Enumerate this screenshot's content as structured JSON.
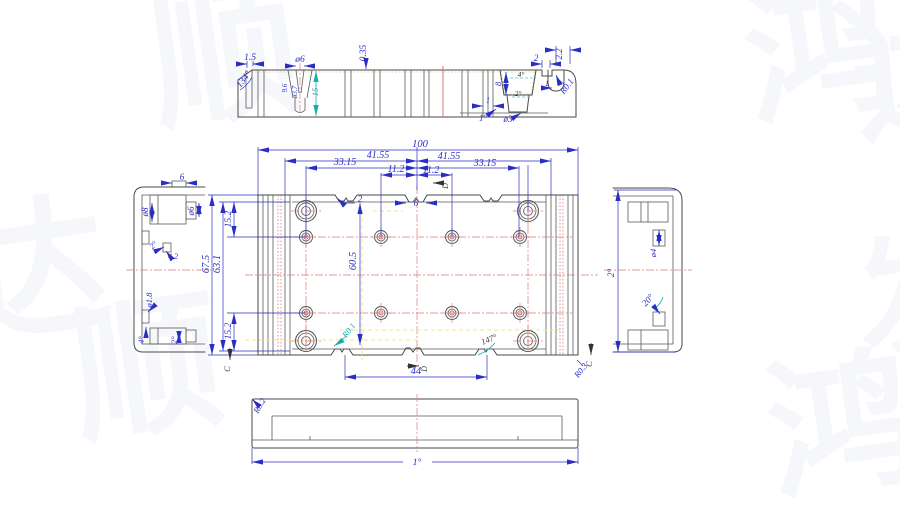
{
  "drawing_title": "sheet-metal-enclosure-base-cad-drawing",
  "colors": {
    "dimension_blue": "#2a2ec4",
    "outline_gray": "#4a4a4a",
    "centerline_red": "#e07a7a",
    "highlight_yellow": "#ece98a",
    "aux_teal": "#12aeb4",
    "watermark": "#f6f7fb"
  },
  "watermarks": [
    {
      "text": "顺",
      "x": 150,
      "y": -18,
      "size": 150,
      "rotate": -8
    },
    {
      "text": "鸿",
      "x": 745,
      "y": -22,
      "size": 150,
      "rotate": -8
    },
    {
      "text": "达",
      "x": 852,
      "y": 8,
      "size": 140,
      "rotate": -8
    },
    {
      "text": "达",
      "x": -42,
      "y": 198,
      "size": 150,
      "rotate": -8
    },
    {
      "text": "顺",
      "x": 72,
      "y": 295,
      "size": 150,
      "rotate": -8
    },
    {
      "text": "鸿",
      "x": 768,
      "y": 352,
      "size": 150,
      "rotate": -8
    },
    {
      "text": "发",
      "x": 856,
      "y": 228,
      "size": 130,
      "rotate": -8
    }
  ],
  "views": {
    "top_section": {
      "name": "Top section view",
      "labels": [
        {
          "text": "1.5",
          "x": 250,
          "y": 60,
          "fs": 9.5
        },
        {
          "text": "ø6",
          "x": 300,
          "y": 62,
          "fs": 9.5
        },
        {
          "text": "0.35",
          "x": 366,
          "y": 53,
          "r": -90,
          "fs": 9.5
        },
        {
          "text": "134°",
          "x": 246,
          "y": 81,
          "r": -52,
          "fs": 9.5
        },
        {
          "text": "9.6",
          "x": 287,
          "y": 88,
          "r": -90,
          "fs": 7
        },
        {
          "text": "ø3.7",
          "x": 297,
          "y": 92,
          "r": -90,
          "fs": 7
        },
        {
          "text": "15",
          "x": 318,
          "y": 92,
          "r": -90,
          "fs": 8.5,
          "c": "t"
        },
        {
          "text": "4°",
          "x": 521,
          "y": 77,
          "fs": 7.5,
          "c": "k"
        },
        {
          "text": "2°",
          "x": 518,
          "y": 96,
          "fs": 7.5,
          "c": "k"
        },
        {
          "text": "8",
          "x": 501,
          "y": 84,
          "r": -90,
          "fs": 8.5
        },
        {
          "text": "1",
          "x": 488,
          "y": 103,
          "fs": 8
        },
        {
          "text": "1°",
          "x": 483,
          "y": 121,
          "fs": 9
        },
        {
          "text": "ø3",
          "x": 508,
          "y": 122,
          "fs": 9
        },
        {
          "text": "2",
          "x": 536,
          "y": 61,
          "fs": 9
        },
        {
          "text": "1",
          "x": 547,
          "y": 86,
          "fs": 8
        },
        {
          "text": "2.2",
          "x": 562,
          "y": 54,
          "r": -90,
          "fs": 9
        },
        {
          "text": "R0.1",
          "x": 569,
          "y": 88,
          "r": -52,
          "fs": 9
        }
      ]
    },
    "front": {
      "name": "Front (plan) view",
      "labels": [
        {
          "text": "100",
          "x": 420,
          "y": 147,
          "fs": 10.5
        },
        {
          "text": "41.55",
          "x": 378,
          "y": 158,
          "fs": 10
        },
        {
          "text": "41.55",
          "x": 449,
          "y": 159,
          "fs": 10
        },
        {
          "text": "33.15",
          "x": 345,
          "y": 165,
          "fs": 10
        },
        {
          "text": "33.15",
          "x": 485,
          "y": 166,
          "fs": 10
        },
        {
          "text": "11.2",
          "x": 396,
          "y": 172,
          "fs": 10
        },
        {
          "text": "11.2",
          "x": 431,
          "y": 173,
          "fs": 10
        },
        {
          "text": "2",
          "x": 360,
          "y": 202,
          "fs": 9
        },
        {
          "text": "6",
          "x": 416,
          "y": 206,
          "fs": 9
        },
        {
          "text": "D",
          "x": 448,
          "y": 186,
          "r": -90,
          "fs": 8,
          "c": "k"
        },
        {
          "text": "67.5",
          "x": 209,
          "y": 264,
          "r": -90,
          "fs": 10.5
        },
        {
          "text": "63.1",
          "x": 220,
          "y": 264,
          "r": -90,
          "fs": 10.5
        },
        {
          "text": "15.2",
          "x": 231,
          "y": 219,
          "r": -90,
          "fs": 9.5
        },
        {
          "text": "15.2",
          "x": 231,
          "y": 331,
          "r": -90,
          "fs": 9.5
        },
        {
          "text": "60.5",
          "x": 356,
          "y": 261,
          "r": -90,
          "fs": 10.5
        },
        {
          "text": "R0.1",
          "x": 351,
          "y": 332,
          "r": -52,
          "fs": 8.5,
          "c": "t"
        },
        {
          "text": "147°",
          "x": 490,
          "y": 342,
          "r": -22,
          "fs": 8.5,
          "c": "k"
        },
        {
          "text": "R0.3",
          "x": 583,
          "y": 372,
          "r": -52,
          "fs": 8.5
        },
        {
          "text": "44",
          "x": 416,
          "y": 374,
          "fs": 10.5
        },
        {
          "text": "D",
          "x": 427,
          "y": 369,
          "r": -90,
          "fs": 8,
          "c": "k"
        },
        {
          "text": "C",
          "x": 230,
          "y": 369,
          "r": -90,
          "fs": 8.5,
          "c": "k"
        },
        {
          "text": "C",
          "x": 592,
          "y": 364,
          "r": -90,
          "fs": 8.5,
          "c": "k"
        }
      ]
    },
    "left_side": {
      "name": "Left side view",
      "labels": [
        {
          "text": "6",
          "x": 182,
          "y": 180,
          "fs": 9
        },
        {
          "text": "ø8",
          "x": 148,
          "y": 212,
          "r": -90,
          "fs": 9
        },
        {
          "text": "ø6",
          "x": 194,
          "y": 211,
          "r": -90,
          "fs": 9
        },
        {
          "text": "2°",
          "x": 155,
          "y": 247,
          "r": -45,
          "fs": 8
        },
        {
          "text": "4.2",
          "x": 173,
          "y": 259,
          "fs": 8
        },
        {
          "text": "ø1.8",
          "x": 152,
          "y": 300,
          "r": -90,
          "fs": 8.5
        },
        {
          "text": "4°",
          "x": 144,
          "y": 340,
          "r": -90,
          "fs": 8.5
        },
        {
          "text": "2°",
          "x": 177,
          "y": 340,
          "r": -90,
          "fs": 8.5
        }
      ]
    },
    "right_side": {
      "name": "Right side view",
      "labels": [
        {
          "text": "2°",
          "x": 614,
          "y": 273,
          "r": -90,
          "fs": 9.5
        },
        {
          "text": "ø4",
          "x": 656,
          "y": 253,
          "r": -90,
          "fs": 8.5
        },
        {
          "text": "20°",
          "x": 650,
          "y": 302,
          "r": -48,
          "fs": 9
        }
      ]
    },
    "bottom": {
      "name": "Bottom view",
      "labels": [
        {
          "text": "R0.2",
          "x": 262,
          "y": 407,
          "r": -60,
          "fs": 8.5
        },
        {
          "text": "1°",
          "x": 417,
          "y": 465,
          "fs": 9.5
        }
      ]
    }
  }
}
